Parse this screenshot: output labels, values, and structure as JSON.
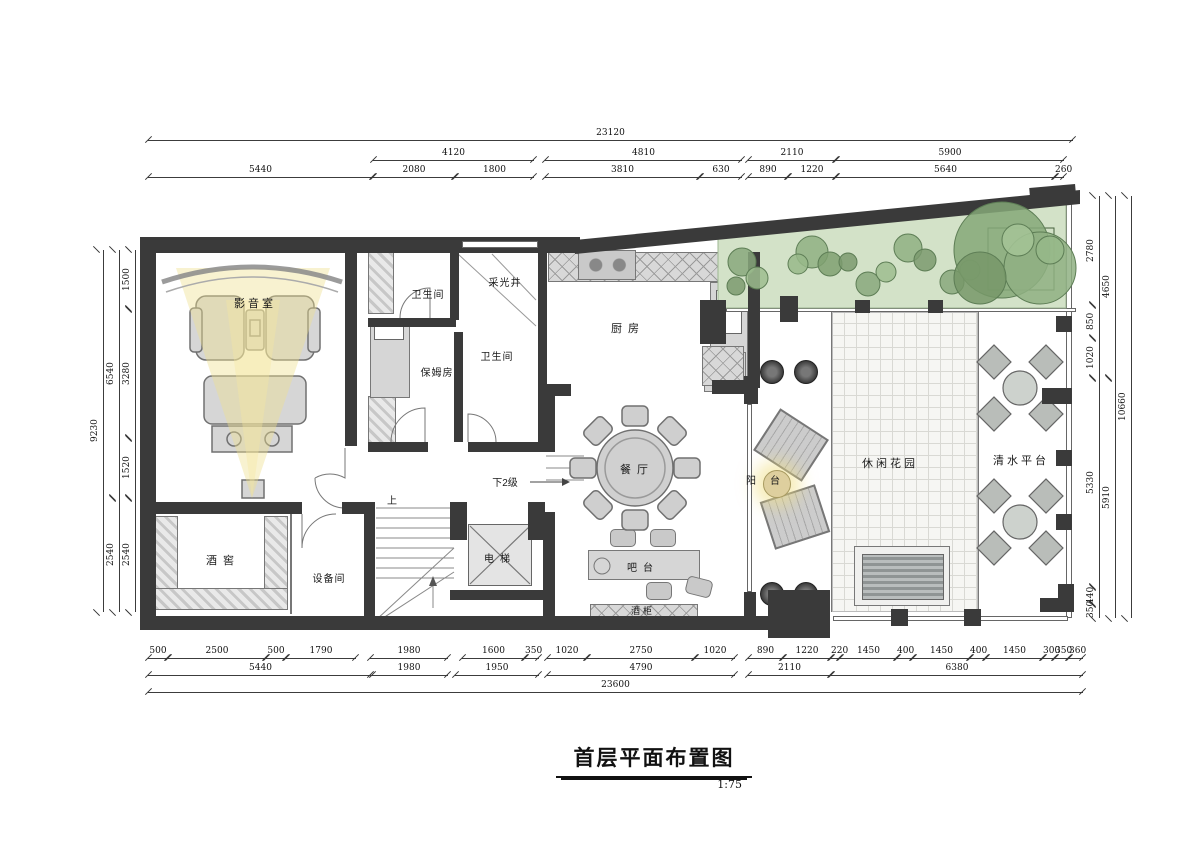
{
  "title": {
    "text": "首层平面布置图",
    "scale": "1:75"
  },
  "rooms": {
    "cinema": "影音室",
    "bath1": "卫生间",
    "lightwell": "采光井",
    "kitchen": "厨房",
    "nanny": "保姆房",
    "bath2": "卫生间",
    "dining": "餐厅",
    "down2": "下2级",
    "up": "上",
    "cellar": "酒窖",
    "equipment": "设备间",
    "elevator": "电梯",
    "bar": "吧台",
    "winecab": "酒柜",
    "balcony": "阳台",
    "garden": "休闲花园",
    "plaza": "清水平台"
  },
  "dims": {
    "top": {
      "total": "23120",
      "t2": [
        "4120",
        "4810",
        "2110",
        "5900"
      ],
      "t3": [
        "5440",
        "2080",
        "1800",
        "3810",
        "630",
        "890",
        "1220",
        "5640",
        "260"
      ]
    },
    "bottom": {
      "t1": [
        "500",
        "2500",
        "500",
        "1790",
        "1980",
        "1600",
        "350",
        "1020",
        "2750",
        "1020",
        "890",
        "1220",
        "220",
        "1450",
        "400",
        "1450",
        "400",
        "1450",
        "300",
        "350",
        "360"
      ],
      "t2": [
        "5440",
        "1980",
        "1950",
        "4790",
        "2110",
        "6380"
      ],
      "total": "23600"
    },
    "left": {
      "outer": "9230",
      "mid": [
        "6540",
        "2540"
      ],
      "inner": [
        "1500",
        "3280",
        "1520",
        "2540"
      ]
    },
    "right": {
      "inner": [
        "2780",
        "850",
        "1020",
        "5330",
        "440",
        "350"
      ],
      "mid": [
        "4650",
        "5910"
      ],
      "outer": "10660"
    }
  },
  "colors": {
    "wall": "#3a3a3a",
    "green": "#d3e2c8",
    "glow": "#efe08e",
    "furniture": "#d6d6d6"
  }
}
